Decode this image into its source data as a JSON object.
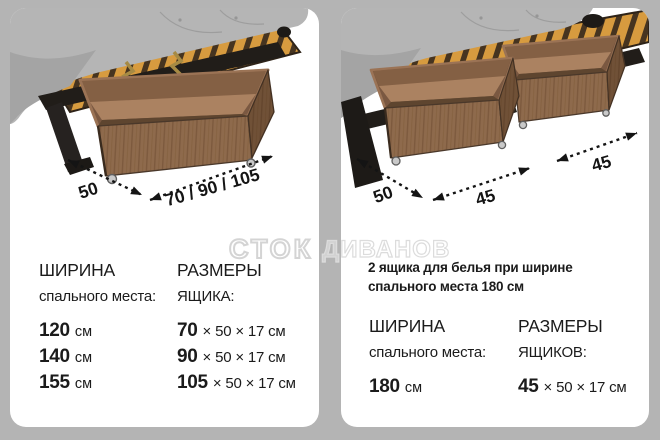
{
  "watermark": {
    "part1": "СТОК",
    "part2": "ДИВАНОВ"
  },
  "left_card": {
    "dims": {
      "depth": "50",
      "widths": "70 / 90 / 105"
    },
    "col1": {
      "title": "ШИРИНА",
      "subtitle": "спального места:",
      "rows": [
        {
          "value": "120",
          "unit": "см"
        },
        {
          "value": "140",
          "unit": "см"
        },
        {
          "value": "155",
          "unit": "см"
        }
      ]
    },
    "col2": {
      "title": "РАЗМЕРЫ",
      "subtitle": "ЯЩИКА:",
      "rows": [
        {
          "value": "70",
          "rest": "× 50 × 17 см"
        },
        {
          "value": "90",
          "rest": "× 50 × 17 см"
        },
        {
          "value": "105",
          "rest": "× 50 × 17 см"
        }
      ]
    }
  },
  "right_card": {
    "note_line1": "2 ящика для белья при ширине",
    "note_line2": "спального места 180 см",
    "dims": {
      "depth": "50",
      "width1": "45",
      "width2": "45"
    },
    "col1": {
      "title": "ШИРИНА",
      "subtitle": "спального места:",
      "rows": [
        {
          "value": "180",
          "unit": "см"
        }
      ]
    },
    "col2": {
      "title": "РАЗМЕРЫ",
      "subtitle": "ЯЩИКОВ:",
      "rows": [
        {
          "value": "45",
          "rest": "× 50 × 17 см"
        }
      ]
    }
  },
  "colors": {
    "background": "#b4b4b4",
    "card": "#ffffff",
    "text": "#1b1b1b",
    "wood": "#8e6a4c",
    "wood_dark": "#6f4f36",
    "wood_floor": "#ab8261",
    "slats": "#d79b3f",
    "cushion": "#b5b5b5",
    "frame": "#211d19",
    "brass": "#a68a44",
    "arrow": "#141414",
    "watermark": "#d6d6d6"
  }
}
